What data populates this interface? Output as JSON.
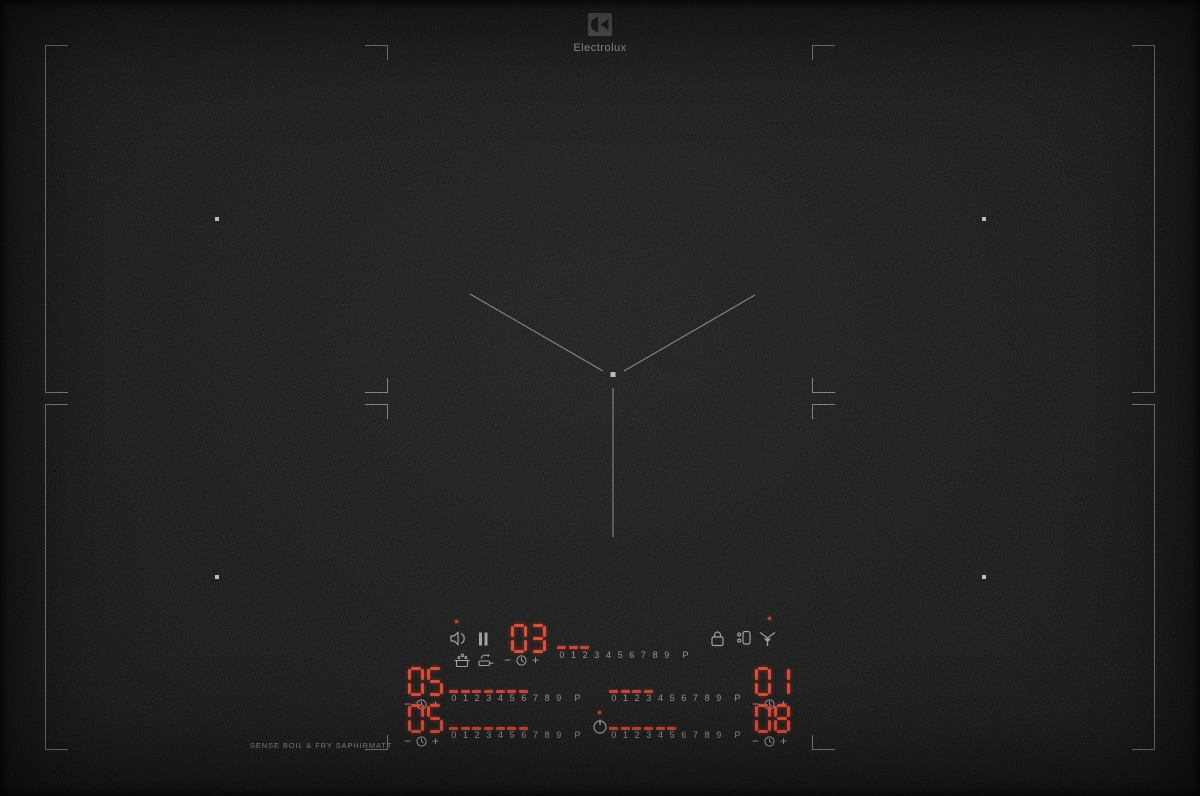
{
  "brand": {
    "logotype": "Electrolux"
  },
  "surface_label": "SENSE BOIL & FRY SAPHIRMATT",
  "scale_numbers": [
    "0",
    "1",
    "2",
    "3",
    "4",
    "5",
    "6",
    "7",
    "8",
    "9",
    "P"
  ],
  "panel": {
    "minus_label": "−",
    "plus_label": "+",
    "zones": {
      "center": {
        "power": "03",
        "lit_dashes": 3
      },
      "back_left": {
        "power": "05",
        "lit_dashes": 7
      },
      "back_right": {
        "power": "01",
        "lit_dashes": 4
      },
      "front_left": {
        "power": "05",
        "lit_dashes": 7
      },
      "front_right": {
        "power": "08",
        "lit_dashes": 6
      }
    },
    "icons": {
      "sound": "sound-icon",
      "pause": "pause-icon",
      "timer": "clock-icon",
      "lock": "lock-icon",
      "bridge": "bridge-icon",
      "hood": "hood-icon",
      "power": "power-icon",
      "sense_boil": "senseboil-icon",
      "sense_fry": "sensefry-icon"
    },
    "indicator_lights": {
      "sound": true,
      "hood": true,
      "power": true
    }
  },
  "colors": {
    "surface": "#141414",
    "line": "#7a7a7a",
    "led": "#e2402a",
    "dash": "#c93a26",
    "icon": "#9b9b9b",
    "scale": "#909090",
    "indicator": "#d43a24"
  }
}
